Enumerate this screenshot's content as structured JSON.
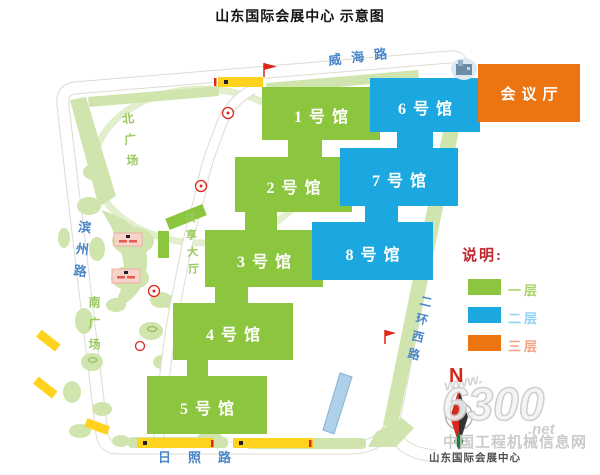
{
  "title": "山东国际会展中心 示意图",
  "map": {
    "halls": [
      {
        "id": "hall-1",
        "label": "1号馆",
        "color": "#8cc63e"
      },
      {
        "id": "hall-2",
        "label": "2号馆",
        "color": "#8cc63e"
      },
      {
        "id": "hall-3",
        "label": "3号馆",
        "color": "#8cc63e"
      },
      {
        "id": "hall-4",
        "label": "4号馆",
        "color": "#8cc63e"
      },
      {
        "id": "hall-5",
        "label": "5号馆",
        "color": "#8cc63e"
      },
      {
        "id": "hall-6",
        "label": "6号馆",
        "color": "#1ba7e0"
      },
      {
        "id": "hall-7",
        "label": "7号馆",
        "color": "#1ba7e0"
      },
      {
        "id": "hall-8",
        "label": "8号馆",
        "color": "#1ba7e0"
      },
      {
        "id": "conference-hall",
        "label": "会议厅",
        "color": "#ec7511"
      }
    ],
    "roads": {
      "north": "威海路",
      "west": "滨州路",
      "south": "日照路",
      "east": "二环西路"
    },
    "areas": {
      "north_plaza": "北广场",
      "south_plaza": "南广场",
      "shared_hall": "共享大厅"
    }
  },
  "legend": {
    "title": "说明:",
    "items": [
      {
        "label": "一层",
        "color": "#8cc63e"
      },
      {
        "label": "二层",
        "color": "#1ba7e0"
      },
      {
        "label": "三层",
        "color": "#ec7511"
      }
    ]
  },
  "compass": {
    "label": "N"
  },
  "watermark": {
    "prefix": "www.",
    "number": "6300",
    "suffix": ".net",
    "site": "中国工程机械信息网"
  },
  "credit": "山东国际会展中心"
}
